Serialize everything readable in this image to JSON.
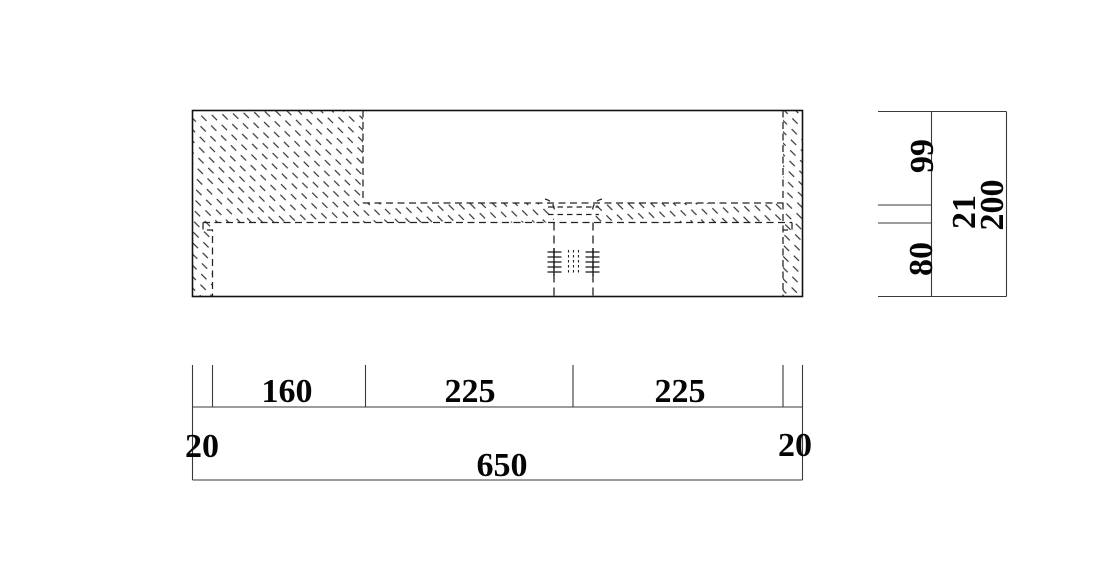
{
  "drawing": {
    "dimensions": {
      "horizontal": {
        "edge_left": "20",
        "block_width": "160",
        "span_left": "225",
        "span_right": "225",
        "edge_right": "20",
        "total": "650"
      },
      "vertical": {
        "upper": "99",
        "band": "21",
        "lower": "80",
        "total": "200"
      }
    }
  }
}
